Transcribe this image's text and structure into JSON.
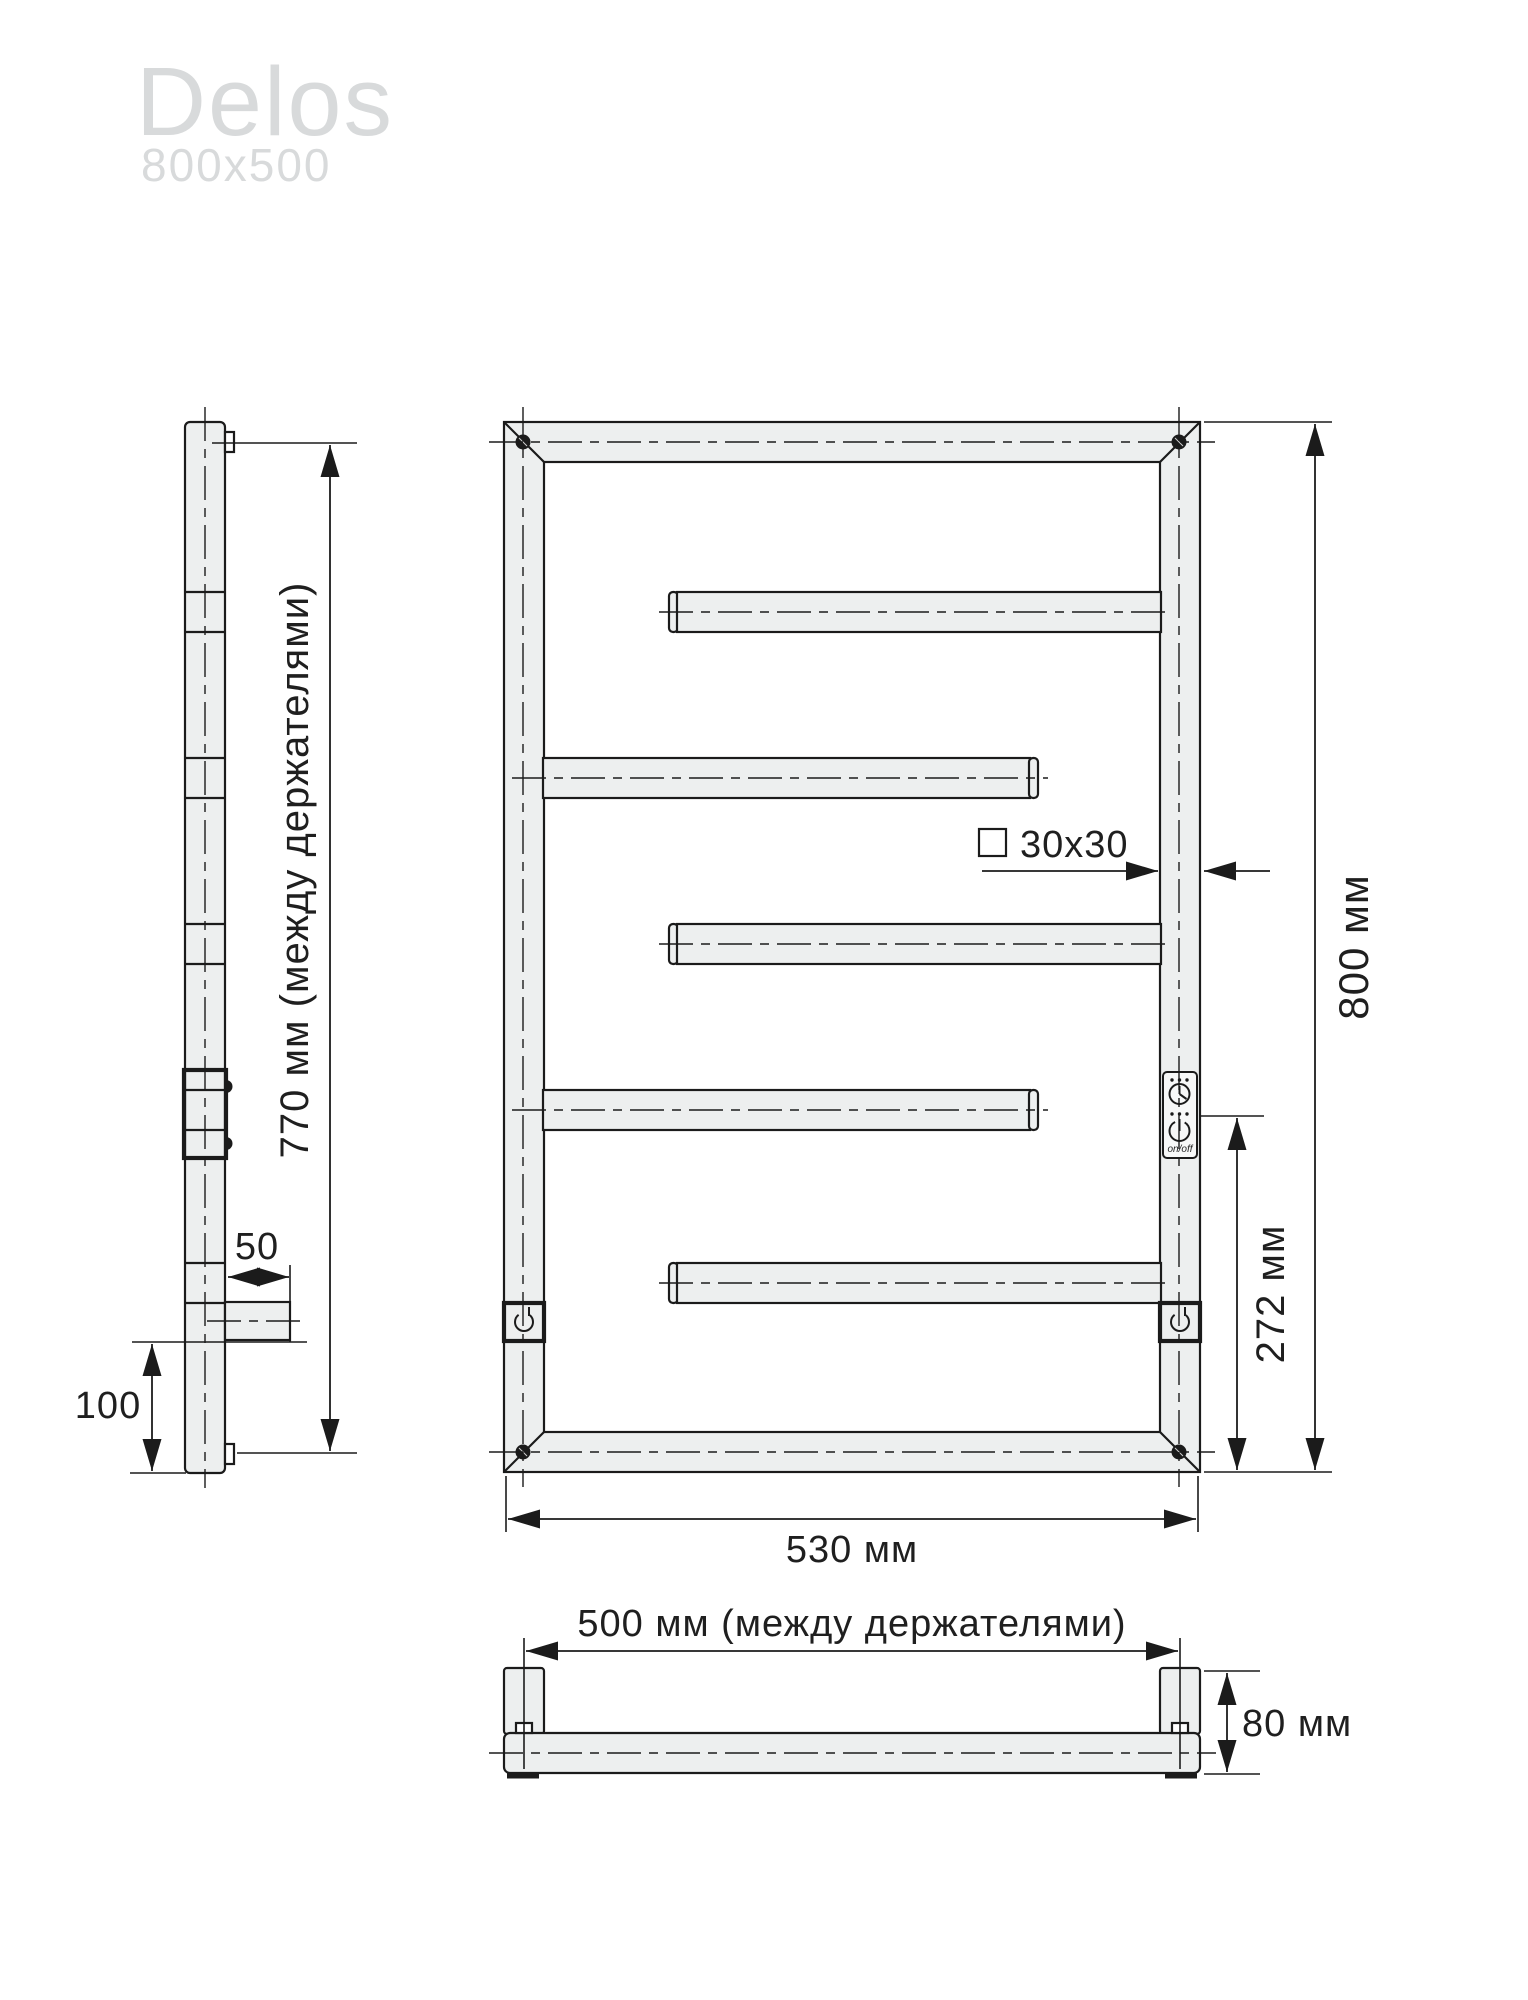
{
  "title": {
    "name": "Delos",
    "size": "800x500"
  },
  "side": {
    "dim_between_holders": "770 мм (между держателями)",
    "dim_standoff": "50",
    "dim_bottom_offset": "100"
  },
  "front": {
    "dim_height": "800 мм",
    "dim_control": "272 мм",
    "dim_width": "530 мм",
    "tube_size": "30x30",
    "control_onoff": "on/off"
  },
  "bottom": {
    "dim_between_holders": "500 мм (между держателями)",
    "dim_depth": "80 мм"
  },
  "colors": {
    "line": "#1b1b1b",
    "fill": "#edefef",
    "title": "#d8dadb"
  }
}
